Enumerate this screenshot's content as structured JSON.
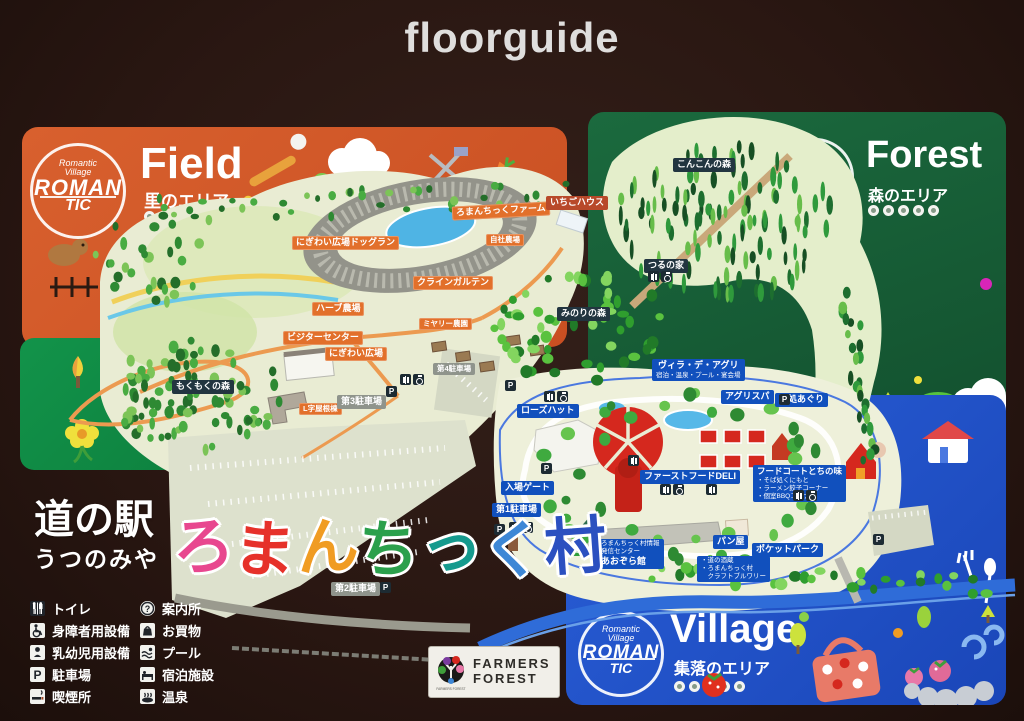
{
  "header": {
    "title": "floorguide"
  },
  "brand": {
    "logo_line1": "Romantic",
    "logo_line2": "Village",
    "logo_word1": "ROMAN",
    "logo_word2": "TIC"
  },
  "panels": {
    "field": {
      "title": "Field",
      "subtitle": "里のエリア"
    },
    "forest": {
      "title": "Forest",
      "subtitle": "森のエリア"
    },
    "village": {
      "title": "Village",
      "subtitle": "集落のエリア"
    }
  },
  "site_title": {
    "prefix": "道の駅",
    "city": "うつのみや",
    "colored": [
      {
        "ch": "ろ",
        "color": "#e8478f"
      },
      {
        "ch": "ま",
        "color": "#e6312a"
      },
      {
        "ch": "ん",
        "color": "#f09c23"
      },
      {
        "ch": "ち",
        "color": "#2ba04c"
      },
      {
        "ch": "っ",
        "color": "#159a8e"
      },
      {
        "ch": "く",
        "color": "#3d87d6"
      },
      {
        "ch": "村",
        "color": "#2b50c0"
      }
    ]
  },
  "labels": {
    "dogrun": "にぎわい広場ドッグラン",
    "farm": "ろまんちっくファーム",
    "ichigo": "いちごハウス",
    "jisha": "自社農場",
    "klein": "クラインガルテン",
    "herb": "ハーブ農場",
    "visitor": "ビジターセンター",
    "nigiwai": "にぎわい広場",
    "miyary": "ミヤリー農園",
    "lji": "L字屋根棟",
    "p1": "第1駐車場",
    "p2": "第2駐車場",
    "p3": "第3駐車場",
    "p4": "第4駐車場",
    "konkon": "こんこんの森",
    "tsuru": "つるの家",
    "minori": "みのりの森",
    "mokumoku": "もくもくの森",
    "villa": "ヴィラ・デ・アグリ",
    "villa_sub": "宿泊・温泉・プール・宴会場",
    "agrispa": "アグリスパ",
    "yudokoro": "湯処あぐり",
    "rosehut": "ローズハット",
    "deli": "ファーストフードDELI",
    "foodcourt": "フードコートとちの味",
    "fc1": "・そば処くにもと",
    "fc2": "・ラーメン餃子コーナー",
    "fc3": "・個室BBQコーナー",
    "gate": "入場ゲート",
    "aozora1": "ろまんちっく村情報",
    "aozora2": "発信センター",
    "aozora3": "あおぞら館",
    "pan": "パン屋",
    "pocket": "ポケットパーク",
    "brew1": "・道の酒蔵",
    "brew2": "・ろまんちっく村",
    "brew3": "　クラフトブルワリー",
    "sakunyu": "搾乳舎"
  },
  "legend": {
    "left": [
      {
        "icon": "toilet",
        "label": "トイレ"
      },
      {
        "icon": "wheelchair",
        "label": "身障者用設備"
      },
      {
        "icon": "baby",
        "label": "乳幼児用設備"
      },
      {
        "icon": "parking",
        "label": "駐車場"
      },
      {
        "icon": "smoking",
        "label": "喫煙所"
      }
    ],
    "right": [
      {
        "icon": "info",
        "label": "案内所"
      },
      {
        "icon": "shopping",
        "label": "お買物"
      },
      {
        "icon": "pool",
        "label": "プール"
      },
      {
        "icon": "lodging",
        "label": "宿泊施設"
      },
      {
        "icon": "onsen",
        "label": "温泉"
      }
    ]
  },
  "farmers": {
    "line1": "FARMERS",
    "line2": "FOREST"
  },
  "glyphs": {
    "parking": "P",
    "info": "?"
  }
}
